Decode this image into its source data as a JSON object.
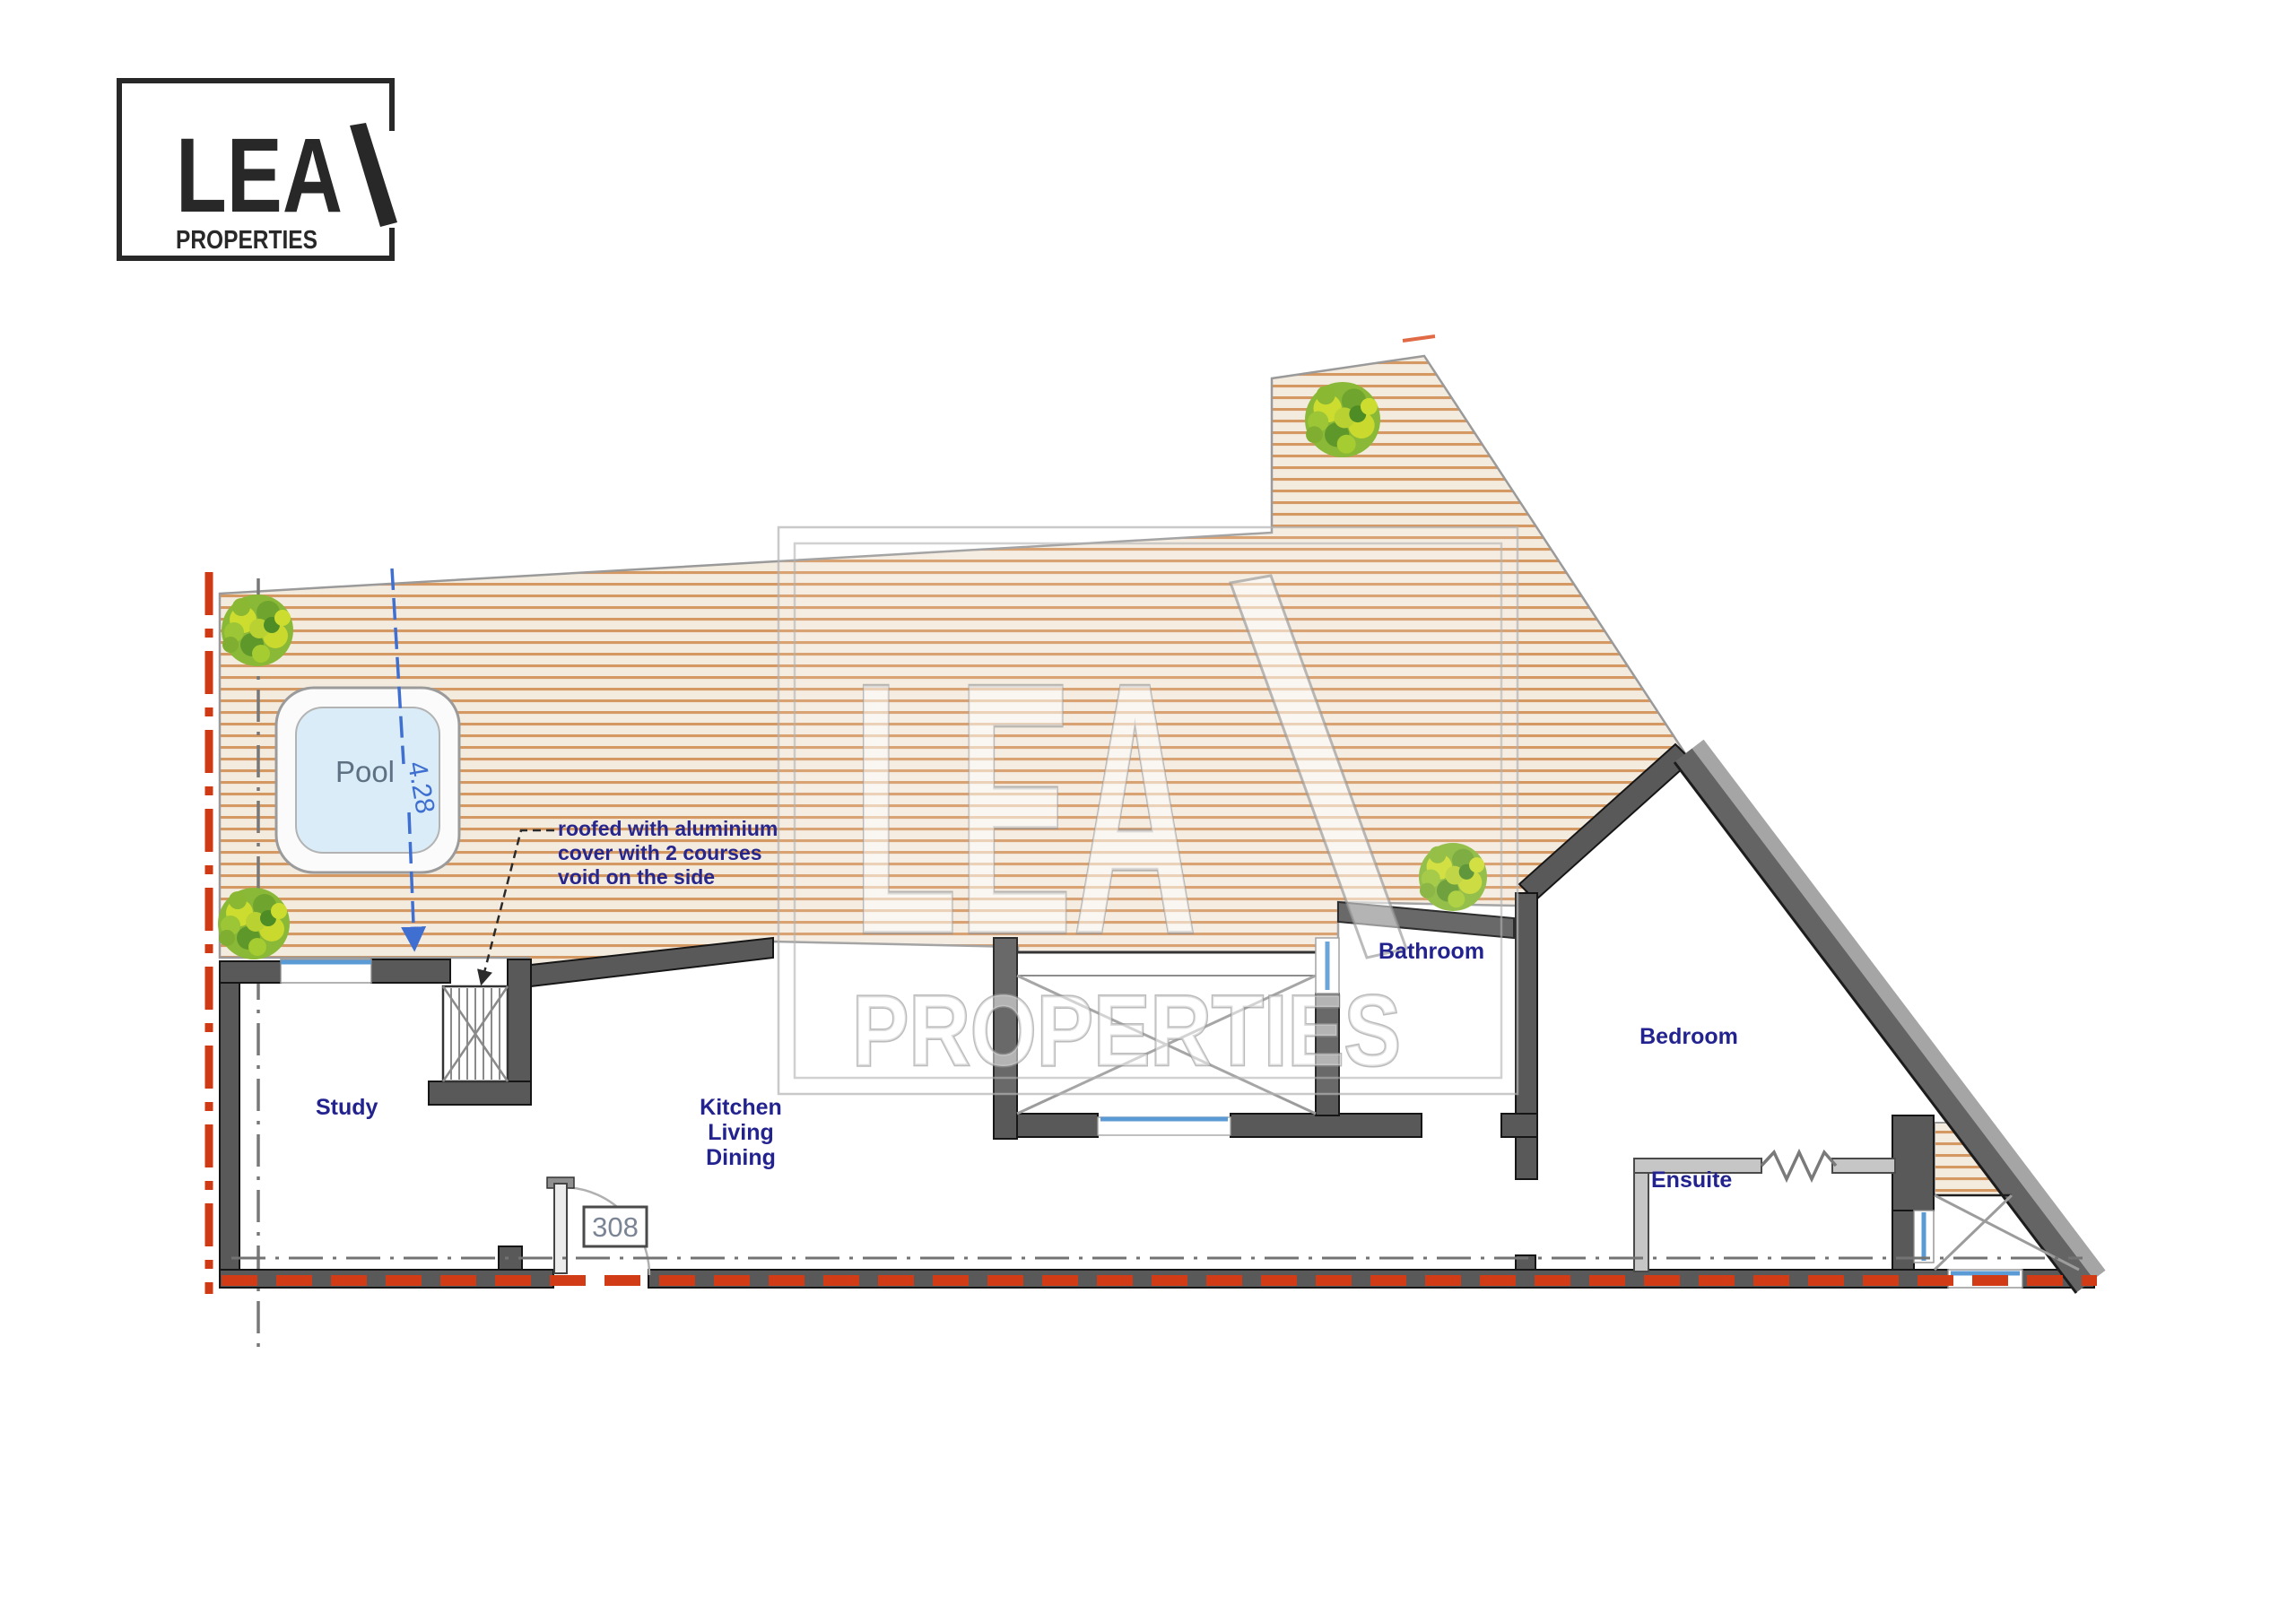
{
  "logo": {
    "brand": "LEA",
    "subtitle": "PROPERTIES"
  },
  "watermark": {
    "brand": "LEA",
    "subtitle": "PROPERTIES"
  },
  "plan": {
    "rooms": {
      "pool": "Pool",
      "study": "Study",
      "kitchen": {
        "line1": "Kitchen",
        "line2": "Living",
        "line3": "Dining"
      },
      "bathroom": "Bathroom",
      "bedroom": "Bedroom",
      "ensuite": "Ensuite"
    },
    "annotation": {
      "line1": "roofed with aluminium",
      "line2": "cover with 2 courses",
      "line3": "void on the side"
    },
    "dimensions": {
      "pool_length": "4.28"
    },
    "door": {
      "number": "308"
    },
    "colors": {
      "deck_stripe": "#cf8a4e",
      "deck_background": "#f4ebdf",
      "wall_dark": "#595959",
      "wall_light": "#c6c6c6",
      "pool_fill": "#d9ecf7",
      "window_blue": "#5b9bd5",
      "dimension_blue": "#3f6fd0",
      "label_blue": "#23238f",
      "pool_label_gray": "#5d7183",
      "boundary_red": "#cf3a15",
      "bush_green": "#8ab837",
      "watermark_gray": "#a8a8a8"
    }
  }
}
